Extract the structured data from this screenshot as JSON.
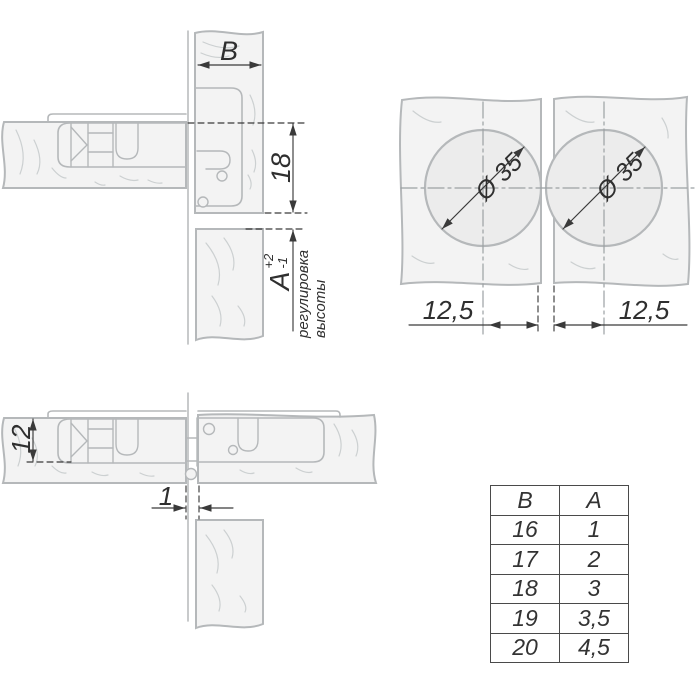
{
  "labels": {
    "door_thickness": "B",
    "overlay": "18",
    "gap_a": "A",
    "gap_tol_plus": "+2",
    "gap_tol_minus": "-1",
    "adjustment_line1": "регулировка",
    "adjustment_line2": "высоты",
    "hole_diameter_left": "Ø 35",
    "hole_diameter_right": "Ø 35",
    "center_offset_left": "12,5",
    "center_offset_right": "12,5",
    "cup_depth": "12",
    "door_gap": "1"
  },
  "table": {
    "headers": [
      "B",
      "A"
    ],
    "rows": [
      [
        "16",
        "1"
      ],
      [
        "17",
        "2"
      ],
      [
        "18",
        "3"
      ],
      [
        "19",
        "3,5"
      ],
      [
        "20",
        "4,5"
      ]
    ]
  },
  "colors": {
    "outline": "#b5b8ba",
    "panel_fill": "#f3f3f3",
    "hole_fill": "#ececec",
    "grain": "#ccd0d1",
    "dimension": "#3a3a3a",
    "centerline": "#9ba1a3",
    "table_border": "#4a4a4a",
    "background": "#ffffff"
  }
}
